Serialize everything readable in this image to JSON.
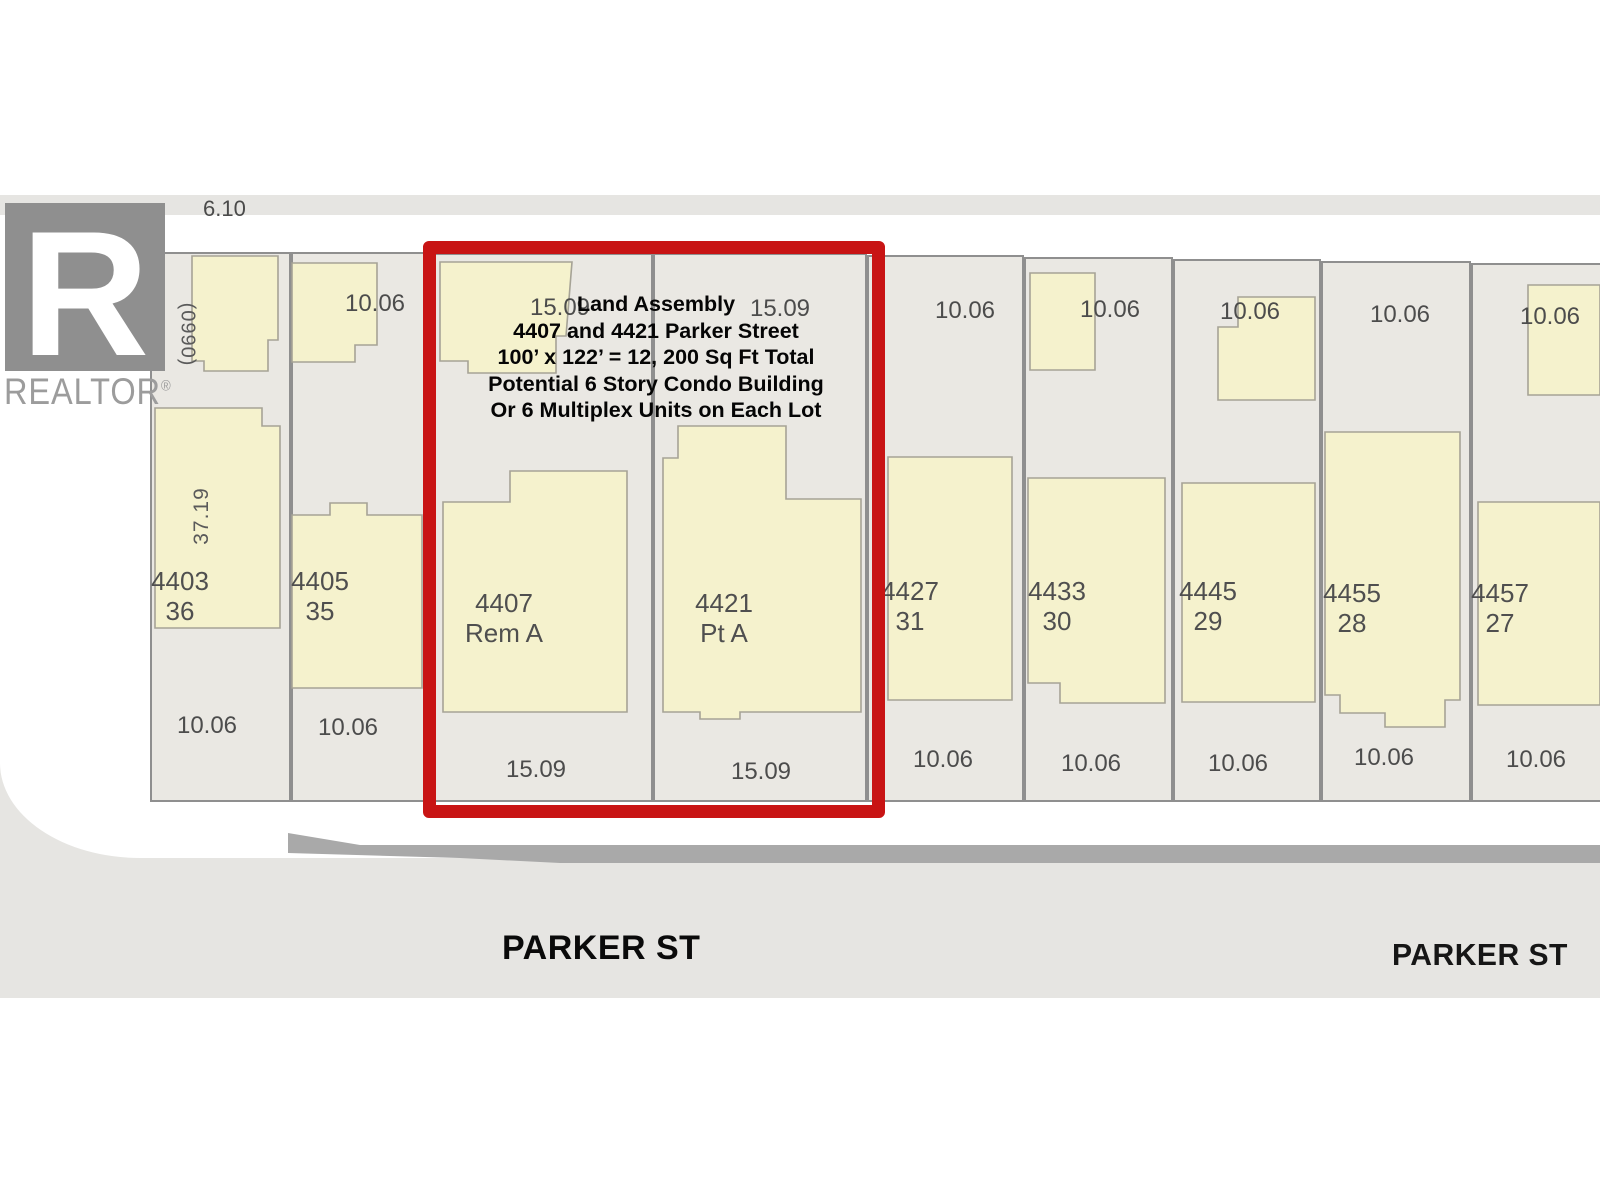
{
  "logo": {
    "letter": "R",
    "brand": "REALTOR",
    "registered": "®"
  },
  "map": {
    "lane_width_label": "6.10",
    "plan_number_label": "(0990)",
    "depth_label": "37.19",
    "street_label_left": "PARKER ST",
    "street_label_right": "PARKER ST"
  },
  "annotation": {
    "lines": [
      "Land Assembly",
      "4407 and 4421 Parker Street",
      "100’ x 122’ = 12, 200 Sq Ft Total",
      "Potential 6 Story Condo Building",
      "Or 6 Multiplex Units on Each Lot"
    ]
  },
  "lots": [
    {
      "house_number": "4403",
      "lot_number": "36",
      "frontage_top": null,
      "frontage_bottom": "10.06",
      "highlighted": false
    },
    {
      "house_number": "4405",
      "lot_number": "35",
      "frontage_top": "10.06",
      "frontage_bottom": "10.06",
      "highlighted": false
    },
    {
      "house_number": "4407",
      "lot_number": "Rem A",
      "frontage_top": "15.09",
      "frontage_bottom": "15.09",
      "highlighted": true
    },
    {
      "house_number": "4421",
      "lot_number": "Pt A",
      "frontage_top": "15.09",
      "frontage_bottom": "15.09",
      "highlighted": true
    },
    {
      "house_number": "4427",
      "lot_number": "31",
      "frontage_top": "10.06",
      "frontage_bottom": "10.06",
      "highlighted": false
    },
    {
      "house_number": "4433",
      "lot_number": "30",
      "frontage_top": "10.06",
      "frontage_bottom": "10.06",
      "highlighted": false
    },
    {
      "house_number": "4445",
      "lot_number": "29",
      "frontage_top": "10.06",
      "frontage_bottom": "10.06",
      "highlighted": false
    },
    {
      "house_number": "4455",
      "lot_number": "28",
      "frontage_top": "10.06",
      "frontage_bottom": "10.06",
      "highlighted": false
    },
    {
      "house_number": "4457",
      "lot_number": "27",
      "frontage_top": "10.06",
      "frontage_bottom": "10.06",
      "highlighted": false
    }
  ],
  "colors": {
    "highlight_red": "#c81414",
    "lot_fill": "#eae8e3",
    "lot_line": "#8f8f8f",
    "footprint_yellow": "#f5f2cd",
    "footprint_line": "#a6a396",
    "street_gray": "#e6e5e2",
    "curb_gray": "#a9a9a9",
    "logo_gray": "#8f8f8f"
  }
}
